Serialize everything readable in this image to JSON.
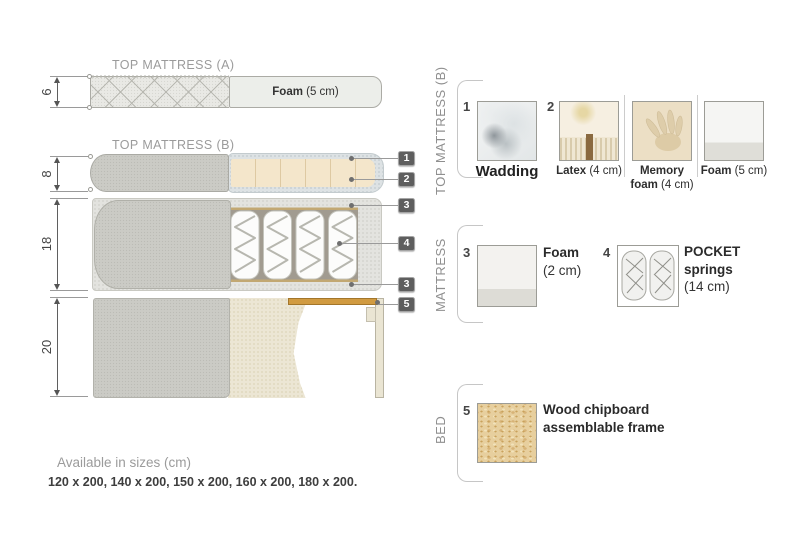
{
  "diagram": {
    "top_mattress_a": {
      "title": "TOP MATTRESS (A)",
      "dimension": "6",
      "foam_bold": "Foam",
      "foam_rest": " (5 cm)"
    },
    "top_mattress_b": {
      "title": "TOP MATTRESS (B)",
      "dimension": "8",
      "tag_wadding": "1",
      "tag_latex": "2"
    },
    "mattress": {
      "dimension": "18",
      "tag_foam_top": "3",
      "tag_springs": "4",
      "tag_foam_bottom": "3"
    },
    "bed": {
      "dimension": "20",
      "tag_frame": "5"
    }
  },
  "legend": {
    "top_mattress_b": {
      "label": "TOP MATTRESS (B)",
      "wadding_num": "1",
      "wadding_name": "Wadding",
      "latex_num": "2",
      "latex_bold": "Latex",
      "latex_rest": " (4 cm)",
      "memory_bold": "Memory foam",
      "memory_rest": " (4 cm)",
      "foam_bold": "Foam",
      "foam_rest": " (5 cm)"
    },
    "mattress": {
      "label": "MATTRESS",
      "foam_num": "3",
      "foam_bold": "Foam",
      "foam_rest": "(2 cm)",
      "springs_num": "4",
      "springs_bold": "POCKET springs",
      "springs_rest": "(14 cm)"
    },
    "bed": {
      "label": "BED",
      "frame_num": "5",
      "frame_name": "Wood chipboard assemblable frame"
    }
  },
  "footer": {
    "availability": "Available in sizes (cm)",
    "sizes": "120 x 200, 140 x 200, 150 x 200, 160 x 200, 180 x 200."
  },
  "colors": {
    "wood_accent": "#cf9a42",
    "tag_background": "#5e5e5e",
    "fabric_gray": "#cbcbc5",
    "latex_beige": "#f4e6cb",
    "wadding_blue_gray": "#dde2e4"
  }
}
